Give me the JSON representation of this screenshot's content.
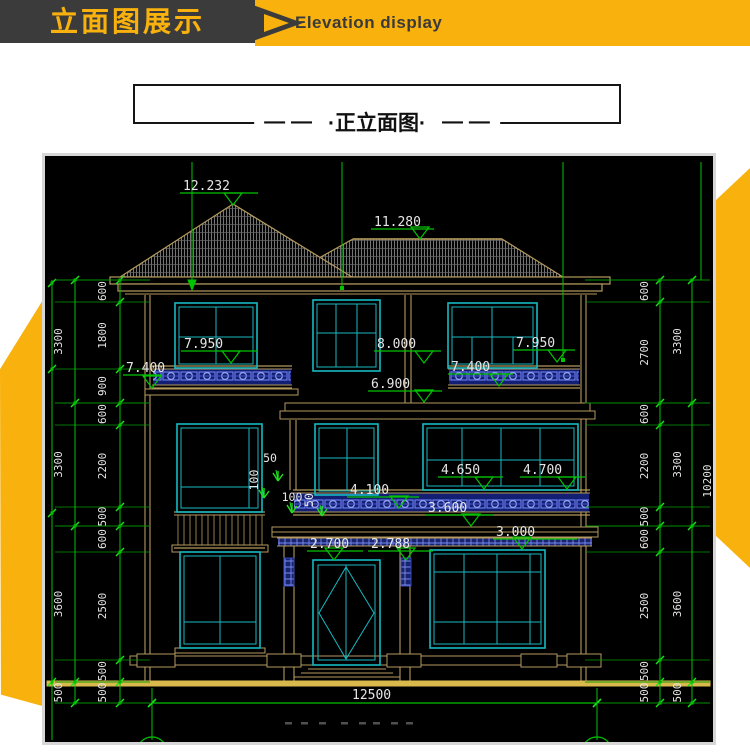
{
  "header": {
    "title_zh": "立面图展示",
    "title_en": "Elevation display"
  },
  "title_box": {
    "dash_left": "— —",
    "label": "·正立面图·",
    "dash_right": "— —"
  },
  "colors": {
    "accent_yellow": "#f9b20d",
    "header_dark": "#3b3b3b",
    "cad_green": "#00c400",
    "cad_tan": "#b49a5e",
    "cad_cyan": "#17b9c2",
    "cad_gold": "#d9b94b",
    "cad_blue": "#5468e8",
    "cad_text": "#e6e6e6"
  },
  "drawing": {
    "elevation_markers": [
      {
        "label": "12.232",
        "tx": 183,
        "ty": 190,
        "lx1": 180,
        "lx2": 258,
        "ly": 193,
        "ax": 233,
        "ay": 205
      },
      {
        "label": "11.280",
        "tx": 374,
        "ty": 226,
        "lx1": 371,
        "lx2": 434,
        "ly": 229,
        "ax": 420,
        "ay": 239
      },
      {
        "label": "7.950",
        "tx": 184,
        "ty": 348,
        "lx1": 181,
        "lx2": 257,
        "ly": 351,
        "ax": 231,
        "ay": 363
      },
      {
        "label": "8.000",
        "tx": 377,
        "ty": 348,
        "lx1": 374,
        "lx2": 441,
        "ly": 351,
        "ax": 424,
        "ay": 363
      },
      {
        "label": "7.400",
        "tx": 126,
        "ty": 372,
        "lx1": 123,
        "lx2": 162,
        "ly": 375,
        "ax": 152,
        "ay": 388
      },
      {
        "label": "7.400",
        "tx": 451,
        "ty": 371,
        "lx1": 448,
        "lx2": 513,
        "ly": 374,
        "ax": 499,
        "ay": 386
      },
      {
        "label": "7.950",
        "tx": 516,
        "ty": 347,
        "lx1": 513,
        "lx2": 575,
        "ly": 350,
        "ax": 557,
        "ay": 362
      },
      {
        "label": "6.900",
        "tx": 371,
        "ty": 388,
        "lx1": 368,
        "lx2": 442,
        "ly": 391,
        "ax": 424,
        "ay": 402
      },
      {
        "label": "4.650",
        "tx": 441,
        "ty": 474,
        "lx1": 438,
        "lx2": 503,
        "ly": 477,
        "ax": 484,
        "ay": 489
      },
      {
        "label": "4.700",
        "tx": 523,
        "ty": 474,
        "lx1": 520,
        "lx2": 585,
        "ly": 477,
        "ax": 567,
        "ay": 489
      },
      {
        "label": "4.100",
        "tx": 350,
        "ty": 494,
        "lx1": 347,
        "lx2": 419,
        "ly": 497,
        "ax": 399,
        "ay": 508
      },
      {
        "label": "3.600",
        "tx": 428,
        "ty": 512,
        "lx1": 425,
        "lx2": 493,
        "ly": 515,
        "ax": 471,
        "ay": 526
      },
      {
        "label": "3.000",
        "tx": 496,
        "ty": 536,
        "lx1": 493,
        "lx2": 577,
        "ly": 539,
        "ax": 522,
        "ay": 549
      },
      {
        "label": "2.700",
        "tx": 310,
        "ty": 548,
        "lx1": 307,
        "lx2": 363,
        "ly": 551,
        "ax": 334,
        "ay": 560
      },
      {
        "label": "2.788",
        "tx": 371,
        "ty": 548,
        "lx1": 368,
        "lx2": 433,
        "ly": 551,
        "ax": 406,
        "ay": 560
      }
    ],
    "small_dims": [
      {
        "label": "50",
        "x": 270,
        "y": 462,
        "rot": 0
      },
      {
        "label": "100",
        "x": 258,
        "y": 480,
        "rot": -90
      },
      {
        "label": "100",
        "x": 292,
        "y": 501,
        "rot": 0
      },
      {
        "label": "50",
        "x": 313,
        "y": 500,
        "rot": -90
      }
    ],
    "chains": [
      {
        "x": 120,
        "label_x": 106,
        "ext": [
          55,
          150
        ],
        "bounds": [
          280,
          302,
          369,
          403,
          425,
          507,
          526,
          552,
          660,
          682,
          703
        ],
        "values": [
          "600",
          "1800",
          "900",
          "600",
          "2200",
          "500",
          "600",
          "2500",
          "500",
          "500"
        ]
      },
      {
        "x": 75,
        "label_x": 62,
        "ext": [
          55,
          150
        ],
        "bounds": [
          280,
          403,
          526,
          682,
          703
        ],
        "values": [
          "3300",
          "3300",
          "3600",
          "500"
        ]
      },
      {
        "x": 660,
        "label_x": 648,
        "ext": [
          585,
          710
        ],
        "bounds": [
          280,
          302,
          403,
          425,
          507,
          526,
          552,
          660,
          682,
          703
        ],
        "values": [
          "600",
          "2700",
          "600",
          "2200",
          "500",
          "600",
          "2500",
          "500",
          "500"
        ]
      },
      {
        "x": 692,
        "label_x": 681,
        "ext": [
          585,
          710
        ],
        "bounds": [
          280,
          403,
          526,
          682,
          703
        ],
        "values": [
          "3300",
          "3300",
          "3600",
          "500"
        ]
      }
    ],
    "total_height_label": {
      "label": "10200",
      "x": 711,
      "y": 481
    },
    "bottom_dim": {
      "label": "12500",
      "x1": 152,
      "x2": 597,
      "y": 703,
      "tx": 352,
      "ty": 699
    }
  }
}
